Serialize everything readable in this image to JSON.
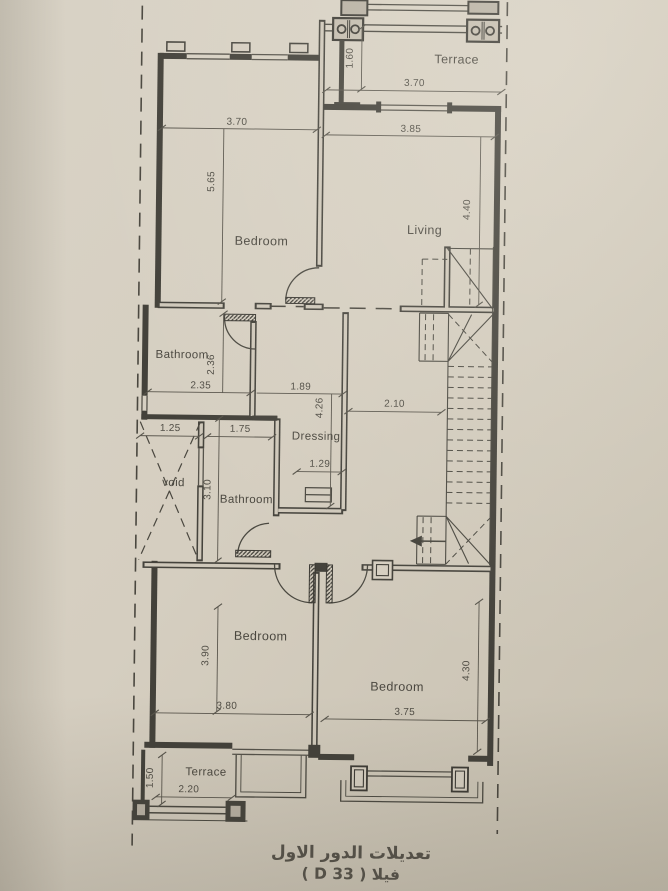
{
  "title": {
    "line1": "تعديلات الدور الاول",
    "line2": "فيلا ( 33 D )"
  },
  "rooms": {
    "terrace_top": "Terrace",
    "bedroom_top": "Bedroom",
    "living": "Living",
    "bathroom_upper": "Bathroom",
    "dressing": "Dressing",
    "void_shaft": "void",
    "bathroom_lower": "Bathroom",
    "bedroom_bottom_left": "Bedroom",
    "bedroom_bottom_right": "Bedroom",
    "terrace_bottom": "Terrace"
  },
  "dimensions": {
    "terrace_top_width": "3.70",
    "terrace_top_depth": "1.60",
    "bedroom_top_width": "3.70",
    "bedroom_top_depth": "5.65",
    "living_width": "3.85",
    "living_depth": "4.40",
    "bathroom_upper_width": "2.35",
    "bathroom_upper_depth": "2.36",
    "dressing_width": "1.89",
    "dressing_depth": "4.26",
    "hall_width": "2.10",
    "void_width": "1.25",
    "bathroom_lower_width": "1.75",
    "dressing_bottom_width": "1.29",
    "bathroom_lower_depth": "3.10",
    "bedroom_bl_depth": "3.90",
    "bedroom_bl_width": "3.80",
    "bedroom_br_width": "3.75",
    "bedroom_br_depth": "4.30",
    "terrace_bottom_width": "2.20",
    "terrace_bottom_depth": "1.50"
  },
  "colors": {
    "paper": "#d5cec0",
    "ink": "#44423b",
    "dim_ink": "#57544b"
  }
}
